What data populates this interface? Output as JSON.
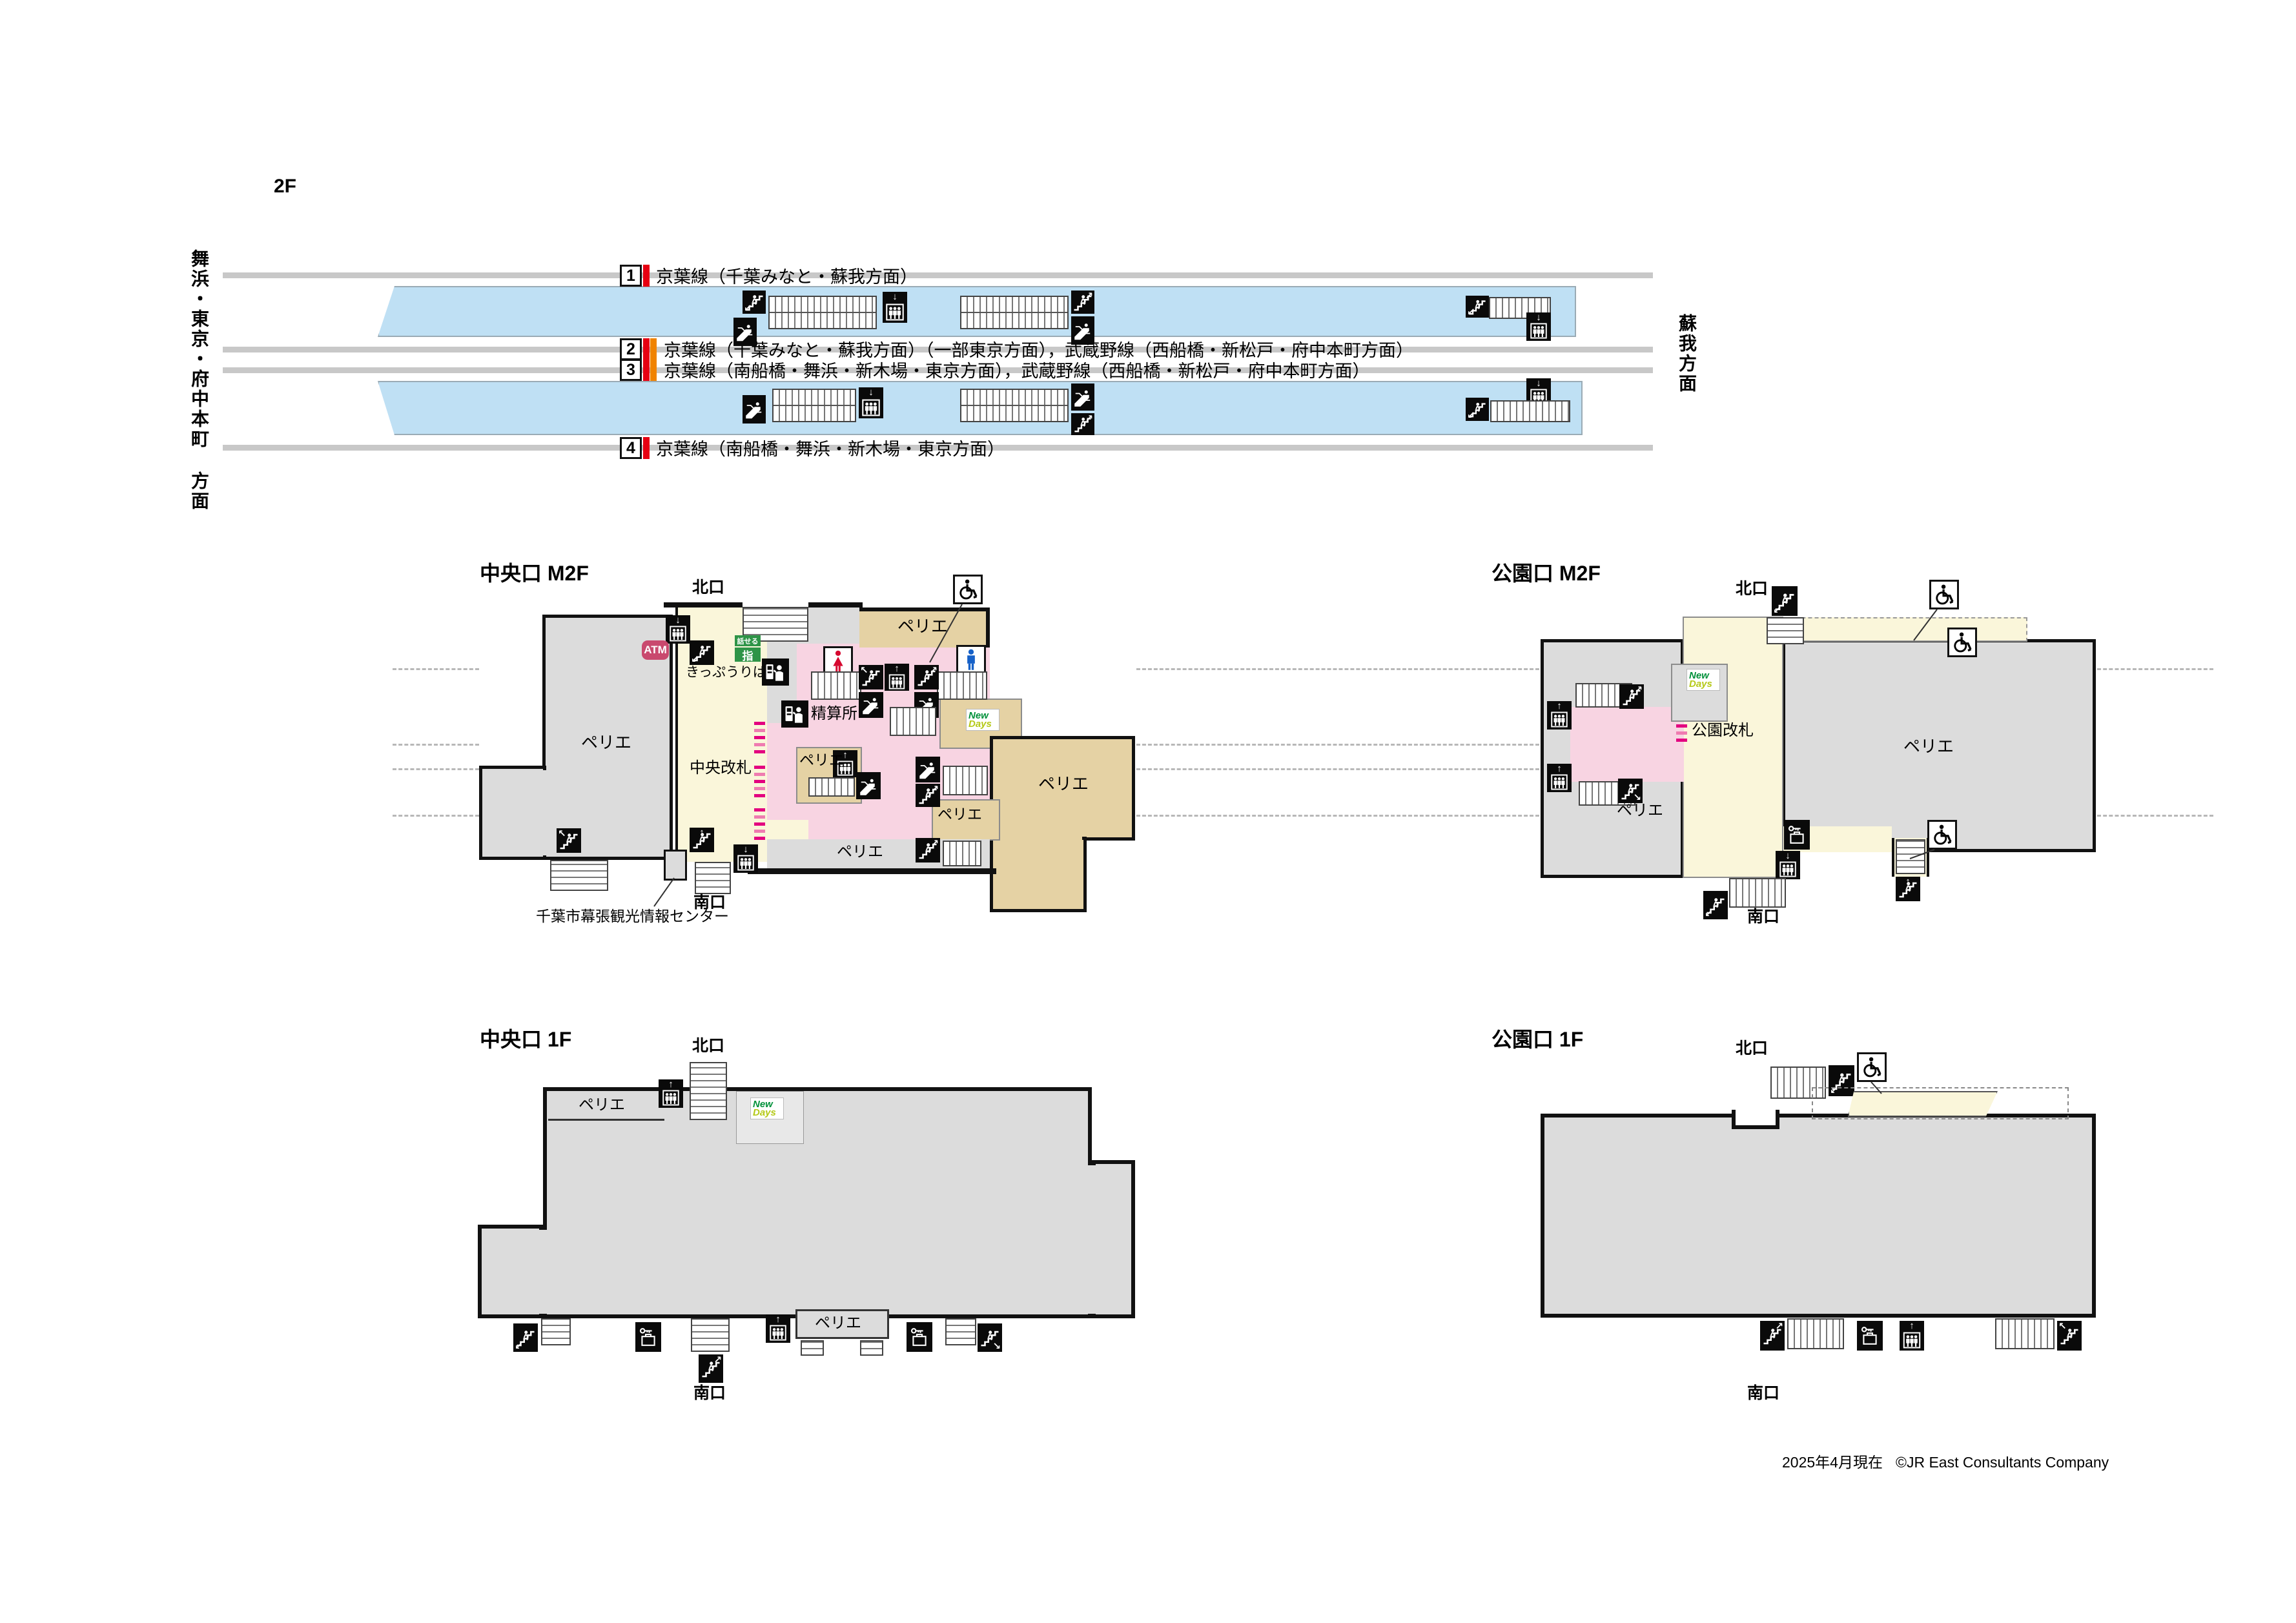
{
  "page": {
    "floor_2f": "2F",
    "updated": "2025年4月現在",
    "credit": "©JR East Consultants Company"
  },
  "directions": {
    "west": "舞浜・東京・府中本町 方面",
    "east": "蘇我方面"
  },
  "platforms": {
    "rows": [
      {
        "num": "1",
        "desc": "京葉線（千葉みなと・蘇我方面）",
        "stripes": [
          "keiyo_red"
        ]
      },
      {
        "num": "2",
        "desc": "京葉線（千葉みなと・蘇我方面）（一部東京方面），武蔵野線（西船橋・新松戸・府中本町方面）",
        "stripes": [
          "keiyo_red",
          "musashino_orange"
        ]
      },
      {
        "num": "3",
        "desc": "京葉線（南船橋・舞浜・新木場・東京方面），武蔵野線（西船橋・新松戸・府中本町方面）",
        "stripes": [
          "keiyo_red",
          "musashino_orange"
        ]
      },
      {
        "num": "4",
        "desc": "京葉線（南船橋・舞浜・新木場・東京方面）",
        "stripes": [
          "keiyo_red"
        ]
      }
    ]
  },
  "sections": {
    "chuo_m2f": "中央口 M2F",
    "koen_m2f": "公園口 M2F",
    "chuo_1f": "中央口 1F",
    "koen_1f": "公園口 1F"
  },
  "labels": {
    "perie": "ペリエ",
    "north_exit": "北口",
    "south_exit": "南口",
    "ticket_office": "きっぷうりば",
    "fare_adjust": "精算所",
    "central_gate": "中央改札",
    "park_gate": "公園改札",
    "atm": "ATM",
    "assist_top": "話せる",
    "assist_bottom": "指",
    "newdays_line1": "New",
    "newdays_line2": "Days",
    "tourist_center": "千葉市幕張観光情報センター"
  },
  "icons": {
    "stairs": "stairs-icon",
    "escalator": "escalator-icon",
    "elevator": "elevator-icon",
    "wheelchair": "wheelchair-accessible-icon",
    "ticket_machine": "ticket-machine-icon",
    "fare_machine": "fare-adjustment-machine-icon",
    "coin_locker": "coin-locker-icon",
    "toilet_female": "female-toilet-icon",
    "toilet_male": "male-toilet-icon"
  },
  "colors": {
    "platform_blue": "#bfe0f4",
    "track_grey": "#c8c8c8",
    "floor_grey": "#dcdcdc",
    "unpaid_cream": "#faf6da",
    "paid_pink": "#f8d4e2",
    "shop_tan": "#e5d2a4",
    "keiyo_red": "#e60012",
    "musashino_orange": "#f08300",
    "gate_magenta": "#e3007f",
    "atm_rose": "#c9496e",
    "assist_green": "#2e9447",
    "newdays_green": "#00913a",
    "newdays_yellow": "#b5c918",
    "toilet_red": "#d60930",
    "toilet_blue": "#1661c8"
  }
}
